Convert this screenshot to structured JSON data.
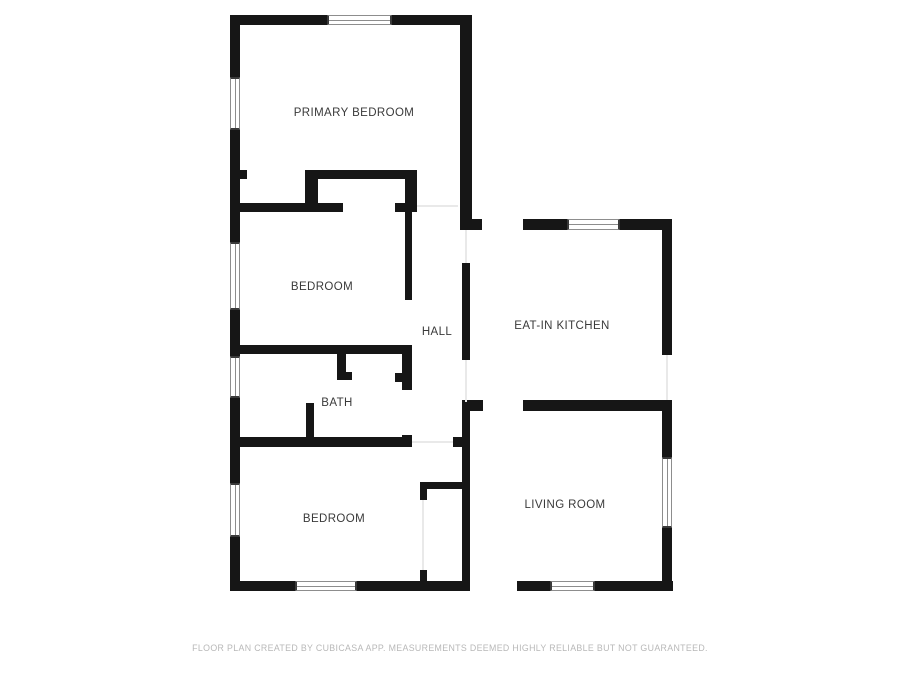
{
  "page": {
    "background_color": "#ffffff",
    "wall_color": "#161616",
    "label_color": "#3a3a3a",
    "disclaimer_color": "#b8b8b8"
  },
  "rooms": [
    {
      "id": "primary-bedroom",
      "label": "PRIMARY BEDROOM",
      "cx": 354,
      "cy": 113
    },
    {
      "id": "bedroom-middle",
      "label": "BEDROOM",
      "cx": 322,
      "cy": 287
    },
    {
      "id": "hall",
      "label": "HALL",
      "cx": 437,
      "cy": 332
    },
    {
      "id": "eat-in-kitchen",
      "label": "EAT-IN KITCHEN",
      "cx": 562,
      "cy": 326
    },
    {
      "id": "bath",
      "label": "BATH",
      "cx": 337,
      "cy": 403
    },
    {
      "id": "bedroom-lower",
      "label": "BEDROOM",
      "cx": 334,
      "cy": 519
    },
    {
      "id": "living-room",
      "label": "LIVING ROOM",
      "cx": 565,
      "cy": 505
    }
  ],
  "footer": {
    "text": "FLOOR PLAN CREATED BY CUBICASA APP. MEASUREMENTS DEEMED HIGHLY RELIABLE BUT NOT GUARANTEED."
  },
  "geometry": {
    "walls": [
      {
        "x": 230,
        "y": 15,
        "w": 242,
        "h": 10
      },
      {
        "x": 230,
        "y": 15,
        "w": 10,
        "h": 576
      },
      {
        "x": 230,
        "y": 581,
        "w": 443,
        "h": 10
      },
      {
        "x": 460,
        "y": 15,
        "w": 12,
        "h": 213
      },
      {
        "x": 460,
        "y": 219,
        "w": 212,
        "h": 11
      },
      {
        "x": 662,
        "y": 219,
        "w": 10,
        "h": 136
      },
      {
        "x": 662,
        "y": 400,
        "w": 10,
        "h": 191
      },
      {
        "x": 462,
        "y": 400,
        "w": 210,
        "h": 11
      },
      {
        "x": 462,
        "y": 402,
        "w": 8,
        "h": 179
      },
      {
        "x": 462,
        "y": 263,
        "w": 8,
        "h": 97
      },
      {
        "x": 230,
        "y": 170,
        "w": 182,
        "h": 9
      },
      {
        "x": 230,
        "y": 203,
        "w": 187,
        "h": 9
      },
      {
        "x": 305,
        "y": 170,
        "w": 13,
        "h": 42
      },
      {
        "x": 405,
        "y": 170,
        "w": 12,
        "h": 42
      },
      {
        "x": 405,
        "y": 212,
        "w": 7,
        "h": 133
      },
      {
        "x": 230,
        "y": 345,
        "w": 182,
        "h": 9
      },
      {
        "x": 402,
        "y": 345,
        "w": 10,
        "h": 102
      },
      {
        "x": 395,
        "y": 373,
        "w": 7,
        "h": 9
      },
      {
        "x": 230,
        "y": 437,
        "w": 182,
        "h": 10
      },
      {
        "x": 453,
        "y": 437,
        "w": 10,
        "h": 10
      },
      {
        "x": 337,
        "y": 354,
        "w": 9,
        "h": 26
      },
      {
        "x": 337,
        "y": 372,
        "w": 15,
        "h": 8
      },
      {
        "x": 306,
        "y": 403,
        "w": 8,
        "h": 34
      },
      {
        "x": 420,
        "y": 482,
        "w": 7,
        "h": 18
      },
      {
        "x": 420,
        "y": 482,
        "w": 43,
        "h": 7
      },
      {
        "x": 420,
        "y": 570,
        "w": 7,
        "h": 11
      }
    ],
    "openings": [
      {
        "x": 247,
        "y": 170,
        "w": 58,
        "h": 9
      },
      {
        "x": 343,
        "y": 203,
        "w": 52,
        "h": 9
      },
      {
        "x": 405,
        "y": 300,
        "w": 7,
        "h": 45
      },
      {
        "x": 402,
        "y": 390,
        "w": 10,
        "h": 45
      },
      {
        "x": 482,
        "y": 219,
        "w": 41,
        "h": 11
      },
      {
        "x": 483,
        "y": 400,
        "w": 40,
        "h": 11
      },
      {
        "x": 470,
        "y": 581,
        "w": 47,
        "h": 10
      }
    ],
    "thresholds": [
      {
        "x": 417,
        "y": 205,
        "w": 41,
        "h": 2
      },
      {
        "x": 247,
        "y": 173,
        "w": 58,
        "h": 2
      },
      {
        "x": 343,
        "y": 206,
        "w": 52,
        "h": 2
      },
      {
        "x": 482,
        "y": 223,
        "w": 41,
        "h": 2
      },
      {
        "x": 483,
        "y": 404,
        "w": 40,
        "h": 2
      },
      {
        "x": 470,
        "y": 585,
        "w": 47,
        "h": 2
      },
      {
        "x": 412,
        "y": 441,
        "w": 41,
        "h": 2
      },
      {
        "x": 407,
        "y": 300,
        "w": 2,
        "h": 45
      },
      {
        "x": 406,
        "y": 390,
        "w": 2,
        "h": 45
      },
      {
        "x": 465,
        "y": 230,
        "w": 2,
        "h": 33
      },
      {
        "x": 465,
        "y": 360,
        "w": 2,
        "h": 42
      },
      {
        "x": 666,
        "y": 355,
        "w": 2,
        "h": 45
      },
      {
        "x": 422,
        "y": 500,
        "w": 2,
        "h": 70
      }
    ],
    "windows": [
      {
        "x": 327,
        "y": 15,
        "w": 65,
        "h": 10,
        "o": "h"
      },
      {
        "x": 567,
        "y": 219,
        "w": 53,
        "h": 11,
        "o": "h"
      },
      {
        "x": 295,
        "y": 581,
        "w": 62,
        "h": 10,
        "o": "h"
      },
      {
        "x": 550,
        "y": 581,
        "w": 45,
        "h": 10,
        "o": "h"
      },
      {
        "x": 230,
        "y": 77,
        "w": 10,
        "h": 53,
        "o": "v"
      },
      {
        "x": 230,
        "y": 242,
        "w": 10,
        "h": 68,
        "o": "v"
      },
      {
        "x": 230,
        "y": 356,
        "w": 10,
        "h": 42,
        "o": "v"
      },
      {
        "x": 230,
        "y": 483,
        "w": 10,
        "h": 54,
        "o": "v"
      },
      {
        "x": 662,
        "y": 457,
        "w": 10,
        "h": 71,
        "o": "v"
      }
    ]
  }
}
